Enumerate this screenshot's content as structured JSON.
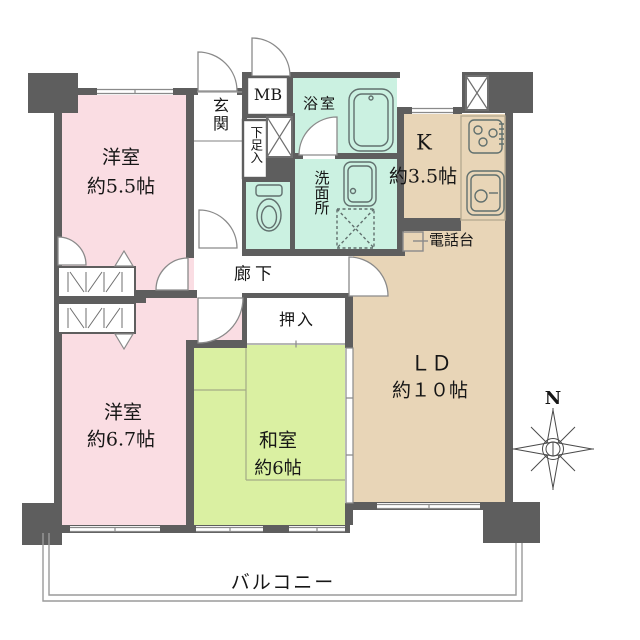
{
  "plan": {
    "rooms": {
      "western_a": {
        "name": "洋室",
        "size": "約5.5帖"
      },
      "western_b": {
        "name": "洋室",
        "size": "約6.7帖"
      },
      "japanese": {
        "name": "和室",
        "size": "約6帖"
      },
      "living": {
        "name": "ＬＤ",
        "size": "約１０帖"
      },
      "kitchen": {
        "name": "K",
        "size": "約3.5帖"
      },
      "entrance": {
        "name": "玄関"
      },
      "meter_box": {
        "name": "MB"
      },
      "shoe_cabinet": {
        "name": "下足入"
      },
      "bathroom": {
        "name": "浴室"
      },
      "washroom": {
        "name": "洗面所"
      },
      "corridor": {
        "name": "廊下"
      },
      "closet": {
        "name": "押入"
      },
      "phone_stand": {
        "name": "電話台"
      },
      "balcony": {
        "name": "バルコニー"
      }
    },
    "compass": {
      "north_label": "N"
    },
    "colors": {
      "wall": "#5e5e5e",
      "western_room": "#fadde3",
      "japanese_room": "#daf0a2",
      "living_kitchen": "#e8d5b7",
      "wet_area": "#cbf1e1"
    }
  }
}
